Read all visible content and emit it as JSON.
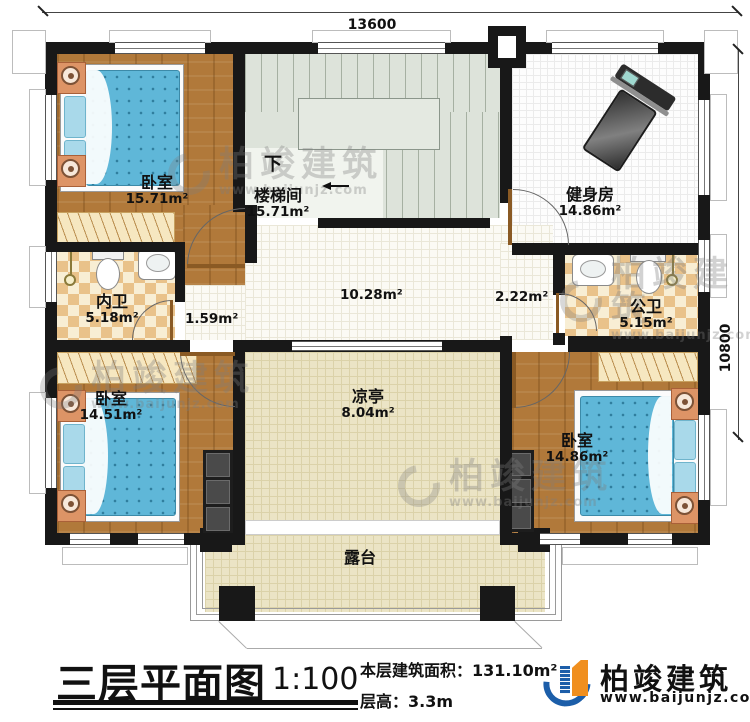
{
  "dimensions": {
    "top": "13600",
    "right": "10800"
  },
  "stairwell": {
    "down_label": "下"
  },
  "rooms": [
    {
      "name": "卧室",
      "area": "15.71m²"
    },
    {
      "name": "楼梯间",
      "area": "15.71m²"
    },
    {
      "name": "健身房",
      "area": "14.86m²"
    },
    {
      "name": "内卫",
      "area": "5.18m²"
    },
    {
      "name": "公卫",
      "area": "5.15m²"
    },
    {
      "name": "卧室",
      "area": "14.51m²"
    },
    {
      "name": "卧室",
      "area": "14.86m²"
    },
    {
      "name": "凉亭",
      "area": "8.04m²"
    },
    {
      "name": "露台"
    }
  ],
  "open_areas": {
    "hall": "10.28m²",
    "corridor": "1.59m²",
    "vestibule": "2.22m²"
  },
  "titleblock": {
    "title": "三层平面图",
    "scale": "1:100",
    "floor_area_label": "本层建筑面积：",
    "floor_area_value": "131.10m²",
    "floor_height_label": "层高：",
    "floor_height_value": "3.3m"
  },
  "brand": {
    "name": "柏竣建筑",
    "website": "www.baijunjz.com"
  },
  "watermark": {
    "name": "柏竣建筑",
    "website": "www.baijunjz.com"
  },
  "colors": {
    "wall": "#181818",
    "wood_floor": "#b1793a",
    "tile_accent": "#e9c28a",
    "stair_floor": "#dde3da",
    "pavilion_floor": "#ebe4c5",
    "mattress_blue": "#5fb7d8",
    "brand_blue": "#1c5ea9",
    "brand_orange": "#f08f1f"
  }
}
